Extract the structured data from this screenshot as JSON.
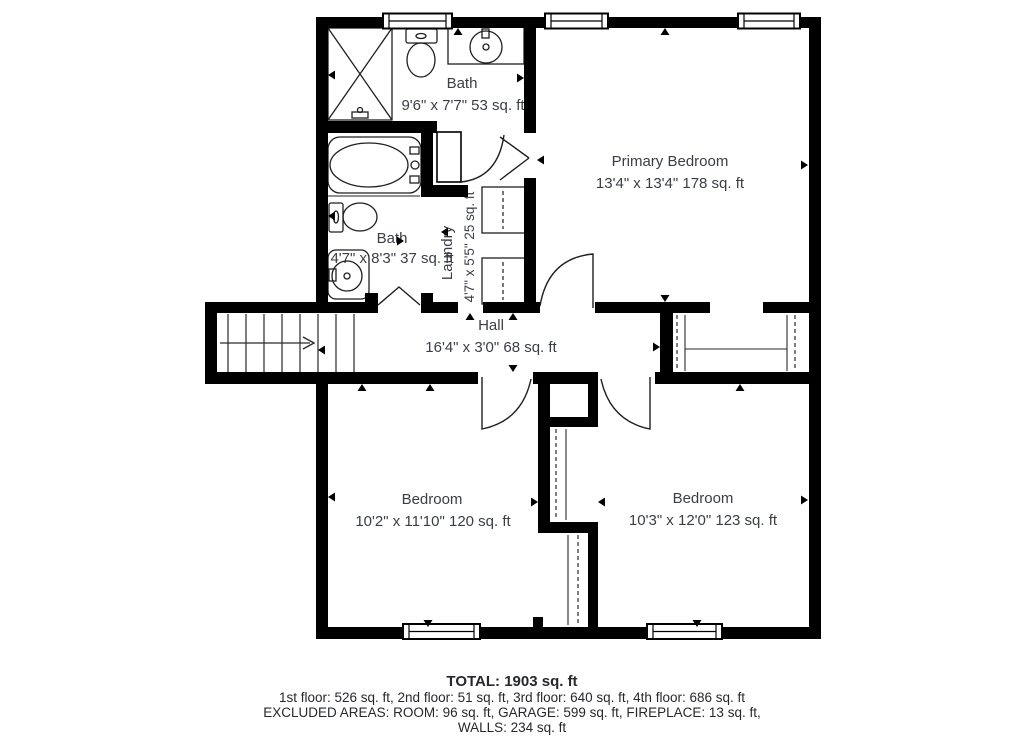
{
  "plan": {
    "rooms": {
      "bath_top": {
        "label": "Bath",
        "dims": "9'6\" x 7'7\" 53 sq. ft"
      },
      "primary_bedroom": {
        "label": "Primary Bedroom",
        "dims": "13'4\" x 13'4\" 178 sq. ft"
      },
      "bath_hall": {
        "label": "Bath",
        "dims": "4'7\" x 8'3\" 37 sq. ft"
      },
      "laundry": {
        "label": "Laundry",
        "dims": "4'7\" x 5'5\" 25 sq. ft"
      },
      "hall": {
        "label": "Hall",
        "dims": "16'4\" x 3'0\" 68 sq. ft"
      },
      "bedroom_left": {
        "label": "Bedroom",
        "dims": "10'2\" x 11'10\" 120 sq. ft"
      },
      "bedroom_right": {
        "label": "Bedroom",
        "dims": "10'3\" x 12'0\" 123 sq. ft"
      }
    },
    "summary": {
      "total": "TOTAL: 1903 sq. ft",
      "floors": "1st floor: 526 sq. ft, 2nd floor: 51 sq. ft, 3rd floor: 640 sq. ft, 4th floor: 686 sq. ft",
      "excluded": "EXCLUDED AREAS: ROOM: 96 sq. ft, GARAGE: 599 sq. ft, FIREPLACE: 13 sq. ft,",
      "walls": "WALLS: 234 sq. ft"
    },
    "icons": [
      "shower-icon",
      "toilet-icon",
      "sink-icon",
      "bathtub-icon",
      "washer-dryer-icon",
      "stairs-icon",
      "door-arc-icon",
      "window-icon",
      "closet-rod-icon",
      "direction-marker-icon"
    ],
    "colors": {
      "wall": "#000000",
      "background": "#ffffff",
      "text": "#3a3e45"
    }
  }
}
